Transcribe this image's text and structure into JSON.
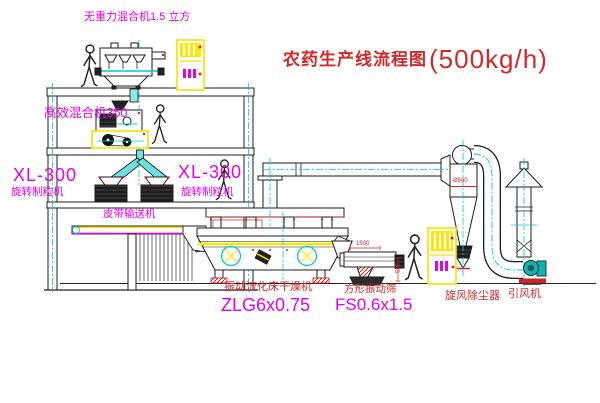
{
  "title": {
    "text": "农药生产线流程图",
    "capacity": "(500kg/h)"
  },
  "labels": {
    "mixer_top": "无重力混合机1.5 立方",
    "mixer_mid": "高效混合机350",
    "granulator_left_model": "XL-300",
    "granulator_left_name": "旋转制粒机",
    "granulator_right_model": "XL-300",
    "granulator_right_name": "旋转制粒机",
    "belt_conveyor": "皮带输送机",
    "dryer_name": "振动流化床干燥机",
    "dryer_model": "ZLG6x0.75",
    "sieve_name": "方形振动筛",
    "sieve_model": "FS0.6x1.5",
    "cyclone_name": "旋风除尘器",
    "fan_name": "引风机"
  },
  "dimensions": {
    "cyclone_diameter": "Ø500",
    "sieve_width": "1500",
    "sieve_height": "345"
  },
  "colors": {
    "label_magenta": "#e800e8",
    "label_red": "#cf2a2a",
    "line_cyan": "#00cccc",
    "highlight_yellow": "#f5e900",
    "accent_red": "#d42222",
    "drawing_black": "#1c1c1c",
    "fan_teal": "#17b0b0",
    "background": "#ffffff"
  }
}
